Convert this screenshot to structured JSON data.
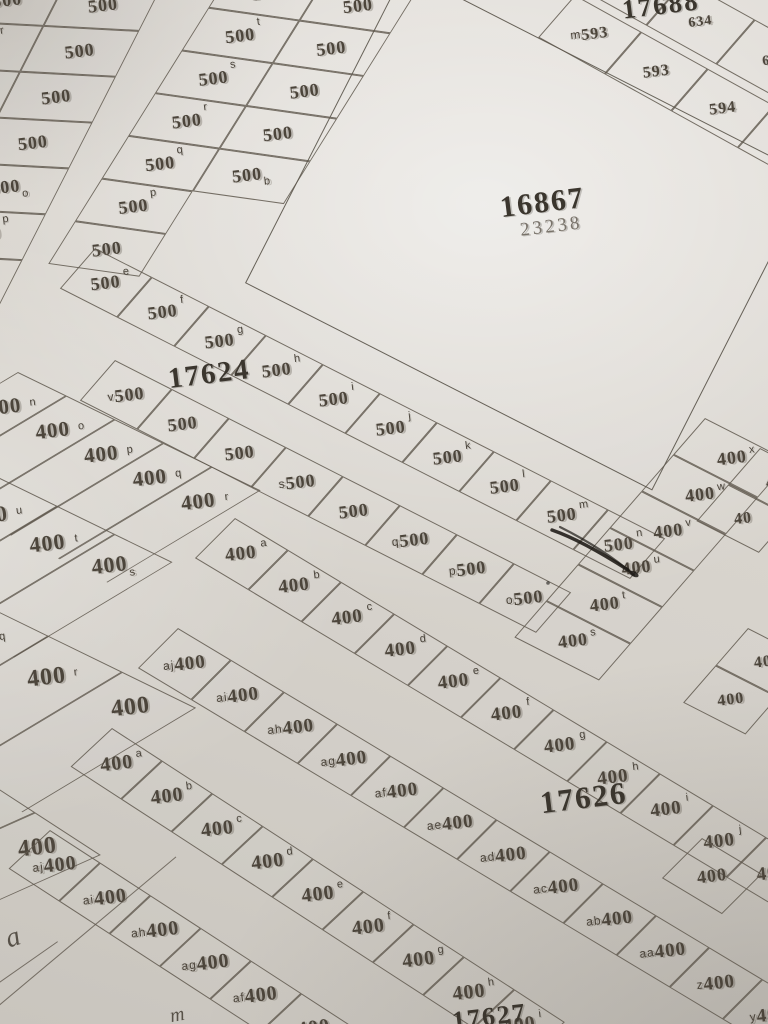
{
  "map_type": "cadastral plat map photo",
  "plot_unit_values": [
    "500",
    "400"
  ],
  "bigplot": {
    "number": "16867",
    "alt_number": "23238",
    "x": 245,
    "y_bottom": 283,
    "w": 457,
    "h": 352,
    "rot": 27
  },
  "labels": [
    {
      "text": "17688",
      "x": 622,
      "y": -10,
      "size": 27,
      "rot": -7,
      "cls": ""
    },
    {
      "text": "16867",
      "x": 500,
      "y": 186,
      "size": 30,
      "rot": -7,
      "cls": ""
    },
    {
      "text": "23238",
      "x": 520,
      "y": 216,
      "size": 19,
      "rot": -7,
      "cls": "muted"
    },
    {
      "text": "17624",
      "x": 168,
      "y": 358,
      "size": 29,
      "rot": -7,
      "cls": ""
    },
    {
      "text": "17626",
      "x": 540,
      "y": 780,
      "size": 31,
      "rot": -7,
      "cls": ""
    },
    {
      "text": "17627",
      "x": 452,
      "y": 1002,
      "size": 26,
      "rot": -7,
      "cls": ""
    }
  ],
  "blocks": [
    {
      "name": "grid-topleft-500",
      "x": -125,
      "y": -30,
      "rot": 3,
      "skew": -24,
      "cw": 96,
      "ch": 47,
      "fs": 18,
      "letterStyle": "corner",
      "rows": [
        [
          {
            "v": "500"
          },
          {
            "v": "500"
          },
          {
            "l": "s",
            "v": "500"
          }
        ],
        [
          {
            "v": "500"
          },
          {
            "l": "r",
            "v": "500"
          },
          {
            "v": "500"
          }
        ],
        [
          {
            "v": "500"
          },
          {
            "l": "q",
            "v": "500"
          },
          {
            "v": "500"
          }
        ],
        [
          {
            "v": "500"
          },
          {
            "l": "b",
            "v": "500"
          },
          {
            "v": "500"
          }
        ],
        [
          {
            "v": "500"
          },
          {
            "l": "c",
            "v": "500"
          },
          {
            "v": "500",
            "s": "o"
          }
        ],
        [
          {
            "v": "500"
          },
          {
            "l": "d",
            "v": "500"
          },
          {
            "l": "p",
            "v": "500"
          }
        ],
        [
          {
            "v": "500"
          },
          {
            "v": "500"
          },
          {
            "v": "500"
          }
        ]
      ]
    },
    {
      "name": "grid-topmid-500",
      "x": 235,
      "y": -35,
      "rot": 8,
      "skew": -24,
      "cw": 92,
      "ch": 46,
      "fs": 18,
      "letterStyle": "corner",
      "rows": [
        [
          {
            "l": "u",
            "v": "500"
          },
          {
            "v": "500"
          }
        ],
        [
          {
            "l": "t",
            "v": "500"
          },
          {
            "v": "500"
          }
        ],
        [
          {
            "l": "s",
            "v": "500"
          },
          {
            "v": "500"
          }
        ],
        [
          {
            "l": "r",
            "v": "500"
          },
          {
            "v": "500"
          }
        ],
        [
          {
            "l": "q",
            "v": "500"
          },
          {
            "v": "500",
            "s": "b"
          }
        ],
        [
          {
            "l": "p",
            "v": "500"
          },
          null
        ],
        [
          {
            "v": "500"
          },
          null
        ]
      ]
    },
    {
      "name": "row-17688-upper",
      "x": 615,
      "y": -58,
      "rot": 29,
      "skew": -12,
      "cw": 80,
      "ch": 58,
      "fs": 14,
      "letterStyle": "inline",
      "rows": [
        [
          {
            "l": "n",
            "v": "61"
          },
          {
            "v": "634"
          },
          {
            "v": "63"
          }
        ]
      ]
    },
    {
      "name": "row-17688-lower",
      "x": 575,
      "y": -5,
      "rot": 29,
      "skew": -12,
      "cw": 76,
      "ch": 55,
      "fs": 16,
      "letterStyle": "inline",
      "rows": [
        [
          {
            "l": "m",
            "v": "593"
          },
          {
            "v": "593"
          },
          {
            "v": "594"
          },
          {
            "v": "560"
          },
          {
            "v": "56"
          }
        ]
      ]
    },
    {
      "name": "row-17624-upper",
      "x": 95,
      "y": 248,
      "rot": 27,
      "skew": -14,
      "cw": 64,
      "ch": 52,
      "fs": 18,
      "letterStyle": "corner",
      "rows": [
        [
          {
            "l": "e",
            "v": "500"
          },
          {
            "l": "f",
            "v": "500"
          },
          {
            "l": "g",
            "v": "500"
          },
          {
            "l": "h",
            "v": "500"
          },
          {
            "l": "i",
            "v": "500"
          },
          {
            "l": "j",
            "v": "500"
          },
          {
            "l": "k",
            "v": "500"
          },
          {
            "l": "l",
            "v": "500"
          },
          {
            "l": "m",
            "v": "500"
          },
          {
            "l": "n",
            "v": "500"
          }
        ]
      ]
    },
    {
      "name": "row-17624-lower",
      "x": 115,
      "y": 360,
      "rot": 27,
      "skew": -14,
      "cw": 64,
      "ch": 52,
      "fs": 18,
      "letterStyle": "inline",
      "rows": [
        [
          {
            "l": "v",
            "v": "500"
          },
          {
            "v": "500"
          },
          {
            "v": "500"
          },
          {
            "l": "s",
            "v": "500"
          },
          {
            "v": "500"
          },
          {
            "l": "q",
            "v": "500"
          },
          {
            "l": "p",
            "v": "500"
          },
          {
            "l": "o",
            "v": "500"
          }
        ]
      ]
    },
    {
      "name": "strips-nopqr-400",
      "x": 18,
      "y": 372,
      "rot": 26,
      "skew": -33,
      "strip": true,
      "cw": 54,
      "ch": 150,
      "fs": 21,
      "letterStyle": "strip",
      "rows": [
        [
          {
            "l": "n",
            "v": "400"
          },
          {
            "l": "o",
            "v": "400"
          },
          {
            "l": "p",
            "v": "400"
          },
          {
            "l": "q",
            "v": "400"
          },
          {
            "l": "r",
            "v": "400"
          }
        ]
      ]
    },
    {
      "name": "strips-uts-400",
      "x": 0,
      "y": 478,
      "rot": 26,
      "skew": -33,
      "strip": true,
      "cw": 64,
      "ch": 155,
      "fs": 22,
      "letterStyle": "strip",
      "rows": [
        [
          {
            "l": "u",
            "v": "400"
          },
          {
            "l": "t",
            "v": "400"
          },
          {
            "v": "400",
            "s": "s"
          }
        ]
      ]
    },
    {
      "name": "strips-qr-400",
      "x": -25,
      "y": 600,
      "rot": 26,
      "skew": -33,
      "strip": true,
      "cw": 82,
      "ch": 170,
      "fs": 24,
      "letterStyle": "strip",
      "rows": [
        [
          {
            "l": "q",
            "v": "400"
          },
          {
            "l": "r",
            "v": "400"
          },
          {
            "v": "400"
          }
        ]
      ]
    },
    {
      "name": "strips-s-400",
      "x": -30,
      "y": 770,
      "rot": 33,
      "skew": -33,
      "strip": true,
      "cw": 78,
      "ch": 170,
      "fs": 24,
      "letterStyle": "strip",
      "rows": [
        [
          {
            "v": "400",
            "s": "s"
          },
          {
            "v": "400"
          }
        ]
      ]
    },
    {
      "name": "row-17626-upper",
      "x": 235,
      "y": 518,
      "rot": 31,
      "skew": -14,
      "cw": 62,
      "ch": 55,
      "fs": 19,
      "letterStyle": "corner",
      "rows": [
        [
          {
            "l": "a",
            "v": "400"
          },
          {
            "l": "b",
            "v": "400"
          },
          {
            "l": "c",
            "v": "400"
          },
          {
            "l": "d",
            "v": "400"
          },
          {
            "l": "e",
            "v": "400"
          },
          {
            "l": "f",
            "v": "400"
          },
          {
            "l": "g",
            "v": "400"
          },
          {
            "l": "h",
            "v": "400"
          },
          {
            "l": "i",
            "v": "400"
          },
          {
            "l": "j",
            "v": "400"
          },
          {
            "l": "k",
            "v": "400"
          }
        ]
      ]
    },
    {
      "name": "row-17626-lower",
      "x": 178,
      "y": 628,
      "rot": 31,
      "skew": -14,
      "cw": 62,
      "ch": 55,
      "fs": 19,
      "letterStyle": "inline",
      "rows": [
        [
          {
            "l": "aj",
            "v": "400"
          },
          {
            "l": "ai",
            "v": "400"
          },
          {
            "l": "ah",
            "v": "400"
          },
          {
            "l": "ag",
            "v": "400"
          },
          {
            "l": "af",
            "v": "400"
          },
          {
            "l": "ae",
            "v": "400"
          },
          {
            "l": "ad",
            "v": "400"
          },
          {
            "l": "ac",
            "v": "400"
          },
          {
            "l": "ab",
            "v": "400"
          },
          {
            "l": "aa",
            "v": "400"
          },
          {
            "l": "z",
            "v": "400"
          },
          {
            "l": "y",
            "v": "400"
          }
        ]
      ]
    },
    {
      "name": "col-right-400",
      "x": 705,
      "y": 418,
      "rot": 27,
      "skew": -14,
      "cw": 95,
      "ch": 47,
      "fs": 18,
      "letterStyle": "corner",
      "rows": [
        [
          {
            "l": "x",
            "v": "400"
          }
        ],
        [
          {
            "l": "w",
            "v": "400"
          }
        ],
        [
          {
            "l": "v",
            "v": "400"
          }
        ],
        [
          {
            "l": "u",
            "v": "400"
          }
        ],
        [
          {
            "l": "t",
            "v": "400"
          }
        ],
        [
          {
            "l": "s",
            "v": "400"
          }
        ]
      ]
    },
    {
      "name": "col-right-edge",
      "x": 760,
      "y": 448,
      "rot": 27,
      "skew": -14,
      "cw": 70,
      "ch": 47,
      "fs": 16,
      "letterStyle": "corner",
      "rows": [
        [
          {
            "v": "40"
          }
        ],
        [
          {
            "v": "40"
          }
        ]
      ]
    },
    {
      "name": "cell-right-partial",
      "x": 748,
      "y": 628,
      "rot": 27,
      "skew": -14,
      "cw": 70,
      "ch": 48,
      "fs": 16,
      "letterStyle": "corner",
      "rows": [
        [
          {
            "v": "40"
          }
        ],
        [
          {
            "v": "400"
          }
        ]
      ]
    },
    {
      "name": "cell-right-mid",
      "x": 702,
      "y": 838,
      "rot": 31,
      "skew": -14,
      "cw": 70,
      "ch": 55,
      "fs": 18,
      "letterStyle": "corner",
      "rows": [
        [
          {
            "v": "400"
          }
        ]
      ]
    },
    {
      "name": "row-bottom-upper",
      "x": 112,
      "y": 728,
      "rot": 33,
      "skew": -14,
      "cw": 60,
      "ch": 55,
      "fs": 20,
      "letterStyle": "corner",
      "rows": [
        [
          {
            "l": "a",
            "v": "400"
          },
          {
            "l": "b",
            "v": "400"
          },
          {
            "l": "c",
            "v": "400"
          },
          {
            "l": "d",
            "v": "400"
          },
          {
            "l": "e",
            "v": "400"
          },
          {
            "l": "f",
            "v": "400"
          },
          {
            "l": "g",
            "v": "400"
          },
          {
            "l": "h",
            "v": "400"
          },
          {
            "l": "i",
            "v": "400"
          }
        ]
      ]
    },
    {
      "name": "row-bottom-lower",
      "x": 50,
      "y": 830,
      "rot": 33,
      "skew": -14,
      "cw": 60,
      "ch": 55,
      "fs": 20,
      "letterStyle": "inline",
      "rows": [
        [
          {
            "l": "aj",
            "v": "400"
          },
          {
            "l": "ai",
            "v": "400"
          },
          {
            "l": "ah",
            "v": "400"
          },
          {
            "l": "ag",
            "v": "400"
          },
          {
            "l": "af",
            "v": "400"
          },
          {
            "l": "ae",
            "v": "400"
          }
        ]
      ]
    }
  ],
  "lines": [
    {
      "x": -12,
      "y": 1014,
      "w": 245,
      "rot": -40
    },
    {
      "x": -18,
      "y": 994,
      "w": 92,
      "rot": -35
    }
  ],
  "hand": [
    {
      "t": "a",
      "x": 6,
      "y": 922,
      "size": 28,
      "rot": -18
    },
    {
      "t": "m",
      "x": 170,
      "y": 1004,
      "size": 20,
      "rot": -10
    }
  ],
  "ink_colors": {
    "print": "#4c453b",
    "pen_scribble": "#1c1915",
    "border": "#5f584e"
  }
}
